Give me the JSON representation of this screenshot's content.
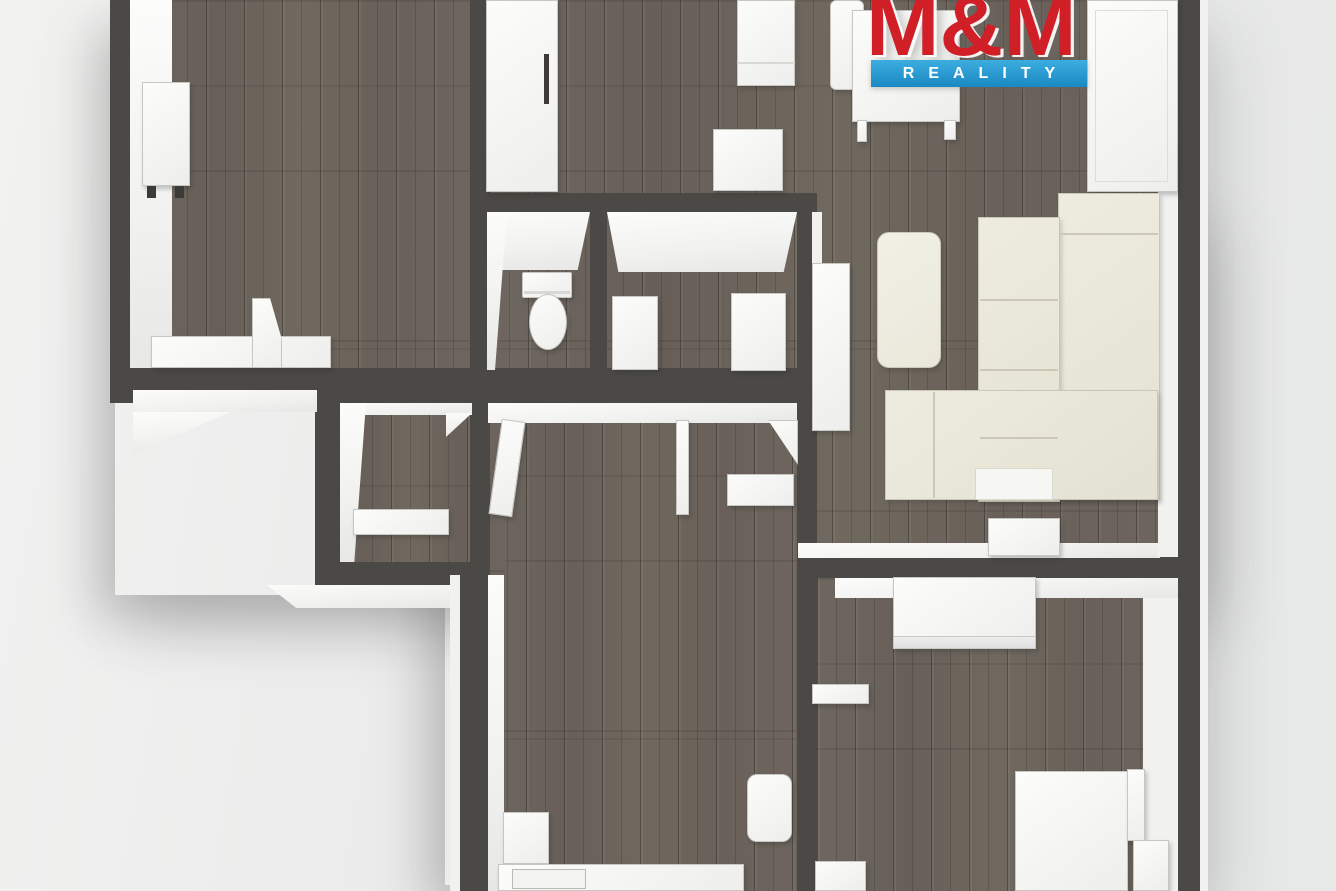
{
  "page": {
    "width": 1336,
    "height": 891,
    "background": "#e9eaea",
    "description": "3D top-down rendered apartment floor plan"
  },
  "logo": {
    "title": "M&M",
    "subtitle": "REALITY",
    "red": "#d01f26",
    "blue": "#1f97d4",
    "text_color": "#ffffff"
  },
  "palette": {
    "wall": "#4b4945",
    "floor_wood": "#6b645c",
    "furniture_white": "#f7f7f6",
    "sofa_cream": "#e9e7d9",
    "inner_face": "#f4f4f3",
    "background": "#e9eaea"
  },
  "plan": {
    "layers": [
      {
        "name": "shadows",
        "items": [
          {
            "n": "apartment-shadow-upper",
            "c": "shadowbox",
            "x": 115,
            "y": 5,
            "w": 1085,
            "h": 590
          },
          {
            "n": "apartment-shadow-lower",
            "c": "shadowbox",
            "x": 445,
            "y": 200,
            "w": 755,
            "h": 685
          }
        ]
      },
      {
        "name": "floors",
        "items": [
          {
            "n": "floor-topleft-room",
            "c": "wood",
            "x": 130,
            "y": 0,
            "w": 340,
            "h": 368
          },
          {
            "n": "floor-living-room",
            "c": "wood",
            "x": 490,
            "y": 0,
            "w": 688,
            "h": 557
          },
          {
            "n": "floor-hallway",
            "c": "wood",
            "x": 488,
            "y": 390,
            "w": 309,
            "h": 501
          },
          {
            "n": "floor-closet",
            "c": "wood",
            "x": 315,
            "y": 400,
            "w": 190,
            "h": 185
          },
          {
            "n": "floor-bedroom",
            "c": "wood",
            "x": 817,
            "y": 578,
            "w": 361,
            "h": 313
          }
        ]
      },
      {
        "name": "walls",
        "items": [
          {
            "n": "wall-topleft-west",
            "c": "wall",
            "x": 110,
            "y": 0,
            "w": 20,
            "h": 392
          },
          {
            "n": "wall-horizontal-main",
            "c": "wall",
            "x": 110,
            "y": 368,
            "w": 705,
            "h": 35
          },
          {
            "n": "wall-middle-vertical",
            "c": "wall",
            "x": 470,
            "y": 0,
            "w": 20,
            "h": 585
          },
          {
            "n": "wall-bathroom-north",
            "c": "wall",
            "x": 470,
            "y": 193,
            "w": 345,
            "h": 19
          },
          {
            "n": "wall-wc-bathroom-divider",
            "c": "wall",
            "x": 590,
            "y": 212,
            "w": 17,
            "h": 160
          },
          {
            "n": "wall-bathroom-east",
            "c": "wall",
            "x": 797,
            "y": 193,
            "w": 20,
            "h": 212
          },
          {
            "n": "wall-hall-west",
            "c": "wall",
            "x": 460,
            "y": 575,
            "w": 28,
            "h": 316
          },
          {
            "n": "wall-closet-west",
            "c": "wall",
            "x": 315,
            "y": 392,
            "w": 25,
            "h": 193
          },
          {
            "n": "wall-closet-south",
            "c": "wall",
            "x": 315,
            "y": 562,
            "w": 173,
            "h": 23
          },
          {
            "n": "wall-hall-east",
            "c": "wall",
            "x": 797,
            "y": 390,
            "w": 20,
            "h": 501
          },
          {
            "n": "wall-living-south",
            "c": "wall",
            "x": 797,
            "y": 557,
            "w": 408,
            "h": 21
          },
          {
            "n": "wall-east",
            "c": "wall",
            "x": 1178,
            "y": 0,
            "w": 27,
            "h": 891
          }
        ]
      },
      {
        "name": "faces",
        "items": [
          {
            "n": "face-topleft-west",
            "c": "face",
            "x": 130,
            "y": 0,
            "w": 42,
            "h": 368
          },
          {
            "n": "face-wc-north",
            "c": "face",
            "x": 487,
            "y": 212,
            "w": 103,
            "h": 58,
            "clip": "polygon(0 0,100% 0,88% 100%,12% 100%)"
          },
          {
            "n": "face-wc-west",
            "c": "face",
            "x": 487,
            "y": 212,
            "w": 20,
            "h": 158,
            "clip": "polygon(0 0,100% 0,40% 100%,0 100%)"
          },
          {
            "n": "face-bathroom-north",
            "c": "face",
            "x": 607,
            "y": 212,
            "w": 190,
            "h": 60,
            "clip": "polygon(0 0,100% 0,93% 100%,6% 100%)"
          },
          {
            "n": "face-bathroom-east-outer",
            "c": "facelight",
            "x": 812,
            "y": 212,
            "w": 10,
            "h": 178
          },
          {
            "n": "face-hall-north",
            "c": "face",
            "x": 488,
            "y": 403,
            "w": 309,
            "h": 20
          },
          {
            "n": "face-closet-north",
            "c": "face",
            "x": 340,
            "y": 403,
            "w": 132,
            "h": 12
          },
          {
            "n": "face-closet-west",
            "c": "face",
            "x": 340,
            "y": 403,
            "w": 26,
            "h": 159,
            "clip": "polygon(0 0,100% 0,55% 100%,0 100%)"
          },
          {
            "n": "face-closet-doorframe",
            "c": "face",
            "x": 446,
            "y": 413,
            "w": 26,
            "h": 24,
            "clip": "polygon(0 0,100% 0,0 100%)"
          },
          {
            "n": "face-living-south",
            "c": "face",
            "x": 798,
            "y": 543,
            "w": 362,
            "h": 15
          },
          {
            "n": "face-bedroom-north",
            "c": "face",
            "x": 835,
            "y": 578,
            "w": 343,
            "h": 20
          },
          {
            "n": "face-living-east",
            "c": "facelight",
            "x": 1158,
            "y": 0,
            "w": 20,
            "h": 557
          },
          {
            "n": "face-bedroom-east",
            "c": "facelight",
            "x": 1143,
            "y": 598,
            "w": 35,
            "h": 293
          },
          {
            "n": "face-hall-west",
            "c": "face",
            "x": 488,
            "y": 575,
            "w": 16,
            "h": 316
          },
          {
            "n": "face-outer-southwest",
            "c": "face",
            "x": 133,
            "y": 390,
            "w": 184,
            "h": 22
          },
          {
            "n": "face-outer-southwest-diagonal",
            "c": "face",
            "x": 133,
            "y": 412,
            "w": 97,
            "h": 43,
            "clip": "polygon(0 0,100% 0,0 100%)"
          },
          {
            "n": "face-outer-closet-south",
            "c": "face",
            "x": 250,
            "y": 585,
            "w": 210,
            "h": 23,
            "clip": "polygon(8% 0,100% 0,100% 100%,22% 100%)"
          },
          {
            "n": "face-outer-hall-west",
            "c": "facelight",
            "x": 450,
            "y": 575,
            "w": 10,
            "h": 316
          },
          {
            "n": "face-outer-east",
            "c": "facelight",
            "x": 1200,
            "y": 0,
            "w": 8,
            "h": 891
          }
        ]
      },
      {
        "name": "furniture",
        "items": [
          {
            "n": "desk",
            "c": "furn",
            "x": 142,
            "y": 82,
            "w": 48,
            "h": 104
          },
          {
            "n": "desk-leg-left",
            "c": "dark",
            "x": 147,
            "y": 186,
            "w": 9,
            "h": 12
          },
          {
            "n": "desk-leg-right",
            "c": "dark",
            "x": 175,
            "y": 186,
            "w": 9,
            "h": 12
          },
          {
            "n": "sideboard-topleft",
            "c": "furn",
            "x": 151,
            "y": 336,
            "w": 180,
            "h": 32
          },
          {
            "n": "door-leaf-topleft",
            "c": "furn",
            "x": 252,
            "y": 298,
            "w": 30,
            "h": 70,
            "clip": "polygon(0 0,60% 0,100% 60%,100% 100%,0 100%)"
          },
          {
            "n": "wardrobe-a",
            "c": "furn",
            "x": 486,
            "y": 0,
            "w": 72,
            "h": 192
          },
          {
            "n": "wardrobe-a-handle",
            "c": "dark",
            "x": 544,
            "y": 54,
            "w": 5,
            "h": 50
          },
          {
            "n": "nightstand",
            "c": "furn",
            "x": 737,
            "y": 0,
            "w": 58,
            "h": 86
          },
          {
            "n": "nightstand-front-line",
            "c": "line2",
            "x": 737,
            "y": 62,
            "w": 58,
            "h": 2
          },
          {
            "n": "stool",
            "c": "furn",
            "x": 713,
            "y": 129,
            "w": 70,
            "h": 62
          },
          {
            "n": "dining-chair",
            "c": "furn",
            "x": 830,
            "y": 0,
            "w": 34,
            "h": 90,
            "r": "6px"
          },
          {
            "n": "dining-table",
            "c": "furn",
            "x": 852,
            "y": 10,
            "w": 108,
            "h": 112
          },
          {
            "n": "table-leg-left",
            "c": "furn",
            "x": 857,
            "y": 120,
            "w": 10,
            "h": 22
          },
          {
            "n": "table-leg-right",
            "c": "furn",
            "x": 944,
            "y": 120,
            "w": 12,
            "h": 20
          },
          {
            "n": "wardrobe-b",
            "c": "furn",
            "x": 1087,
            "y": 0,
            "w": 91,
            "h": 192
          },
          {
            "n": "wardrobe-b-bevel",
            "c": "inset",
            "x": 1095,
            "y": 10,
            "w": 73,
            "h": 172
          },
          {
            "n": "cabinet-tall",
            "c": "furn",
            "x": 812,
            "y": 263,
            "w": 38,
            "h": 168
          },
          {
            "n": "sofa-section-east",
            "c": "cream",
            "x": 1058,
            "y": 193,
            "w": 102,
            "h": 307
          },
          {
            "n": "sofa-section-back",
            "c": "cream",
            "x": 978,
            "y": 217,
            "w": 82,
            "h": 285
          },
          {
            "n": "sofa-chaise",
            "c": "cream",
            "x": 885,
            "y": 390,
            "w": 273,
            "h": 110
          },
          {
            "n": "sofa-cushion-line-1",
            "c": "line",
            "x": 980,
            "y": 299,
            "w": 78,
            "h": 2
          },
          {
            "n": "sofa-cushion-line-2",
            "c": "line",
            "x": 980,
            "y": 369,
            "w": 78,
            "h": 2
          },
          {
            "n": "sofa-cushion-line-3",
            "c": "line",
            "x": 980,
            "y": 437,
            "w": 78,
            "h": 2
          },
          {
            "n": "sofa-armrest-line",
            "c": "line",
            "x": 1060,
            "y": 233,
            "w": 98,
            "h": 2
          },
          {
            "n": "sofa-chaise-divider",
            "c": "line",
            "x": 933,
            "y": 392,
            "w": 2,
            "h": 106
          },
          {
            "n": "sofa-cushion-white",
            "c": "whiteacc",
            "x": 975,
            "y": 468,
            "w": 78,
            "h": 32
          },
          {
            "n": "coffee-table",
            "c": "creamlight",
            "x": 877,
            "y": 232,
            "w": 64,
            "h": 136,
            "r": "12px"
          },
          {
            "n": "sideboard-small",
            "c": "furn",
            "x": 988,
            "y": 518,
            "w": 72,
            "h": 38
          },
          {
            "n": "toilet-tank",
            "c": "furn",
            "x": 522,
            "y": 272,
            "w": 50,
            "h": 26,
            "r": "2px"
          },
          {
            "n": "toilet-tank-lid-line",
            "c": "line2",
            "x": 524,
            "y": 291,
            "w": 46,
            "h": 3
          },
          {
            "n": "toilet-bowl",
            "c": "furn",
            "x": 529,
            "y": 294,
            "w": 38,
            "h": 56,
            "r": "19px / 28px"
          },
          {
            "n": "bathroom-vanity",
            "c": "furn",
            "x": 612,
            "y": 296,
            "w": 46,
            "h": 74
          },
          {
            "n": "washing-machine",
            "c": "furn",
            "x": 731,
            "y": 293,
            "w": 55,
            "h": 78
          },
          {
            "n": "hall-shelf",
            "c": "furn",
            "x": 727,
            "y": 474,
            "w": 67,
            "h": 32
          },
          {
            "n": "closet-shelf",
            "c": "furn",
            "x": 353,
            "y": 509,
            "w": 96,
            "h": 26
          },
          {
            "n": "hall-cabinet",
            "c": "furn",
            "x": 503,
            "y": 812,
            "w": 46,
            "h": 52
          },
          {
            "n": "hall-chair",
            "c": "furn",
            "x": 747,
            "y": 774,
            "w": 45,
            "h": 68,
            "r": "10px"
          },
          {
            "n": "kitchen-counter",
            "c": "furn",
            "x": 498,
            "y": 864,
            "w": 246,
            "h": 27
          },
          {
            "n": "stove",
            "c": "inset2",
            "x": 512,
            "y": 869,
            "w": 74,
            "h": 20
          },
          {
            "n": "bedroom-wardrobe",
            "c": "furn",
            "x": 893,
            "y": 577,
            "w": 143,
            "h": 72
          },
          {
            "n": "bedroom-wardrobe-front",
            "c": "frontface",
            "x": 893,
            "y": 636,
            "w": 143,
            "h": 13
          },
          {
            "n": "bedroom-shelf",
            "c": "furn",
            "x": 812,
            "y": 684,
            "w": 57,
            "h": 20
          },
          {
            "n": "bed",
            "c": "furn",
            "x": 1015,
            "y": 771,
            "w": 113,
            "h": 120
          },
          {
            "n": "bed-edge",
            "c": "furn",
            "x": 1127,
            "y": 769,
            "w": 18,
            "h": 72
          },
          {
            "n": "bed-side-table",
            "c": "furn",
            "x": 1133,
            "y": 840,
            "w": 36,
            "h": 51
          },
          {
            "n": "bedroom-box",
            "c": "furn",
            "x": 815,
            "y": 861,
            "w": 51,
            "h": 30
          },
          {
            "n": "door-leaf-wc",
            "c": "furn",
            "x": 495,
            "y": 420,
            "w": 24,
            "h": 96,
            "rot": 8
          },
          {
            "n": "door-leaf-bathroom",
            "c": "furn",
            "x": 676,
            "y": 420,
            "w": 13,
            "h": 95
          },
          {
            "n": "door-wing-living",
            "c": "furn",
            "x": 768,
            "y": 420,
            "w": 30,
            "h": 45,
            "clip": "polygon(0 0,100% 0,100% 100%)"
          }
        ]
      }
    ]
  }
}
